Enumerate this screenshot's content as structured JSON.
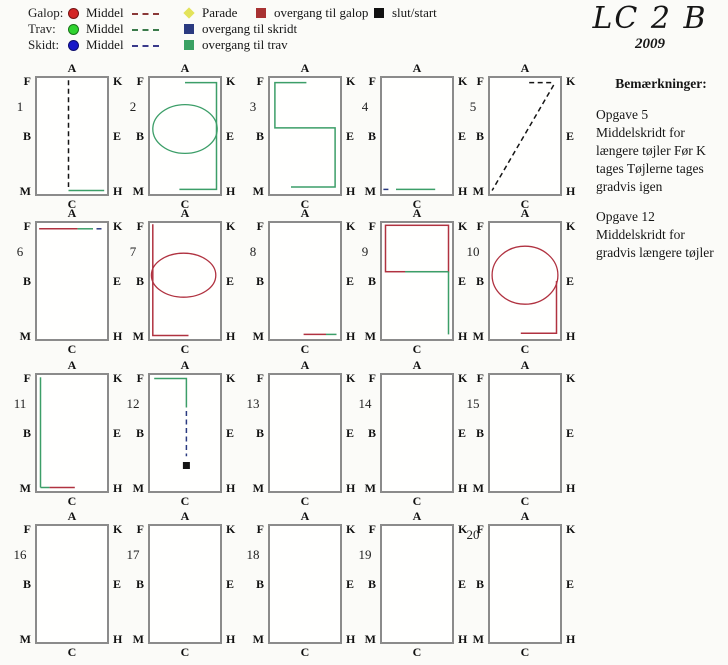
{
  "colors": {
    "green": "#3c9e68",
    "red": "#b03240",
    "navy": "#2a3a80",
    "black": "#151515",
    "rect_border": "#8b8b8b"
  },
  "title": {
    "main": "LC 2 B",
    "year": "2009"
  },
  "legend": {
    "gaits": [
      {
        "label": "Galop:",
        "middel": "Middel",
        "dot_color": "#d42525",
        "dash_color": "#8a3838"
      },
      {
        "label": "Trav:",
        "middel": "Middel",
        "dot_color": "#2fd32f",
        "dash_color": "#3a7a4a"
      },
      {
        "label": "Skidt:",
        "middel": "Middel",
        "dot_color": "#1717c8",
        "dash_color": "#39398a"
      }
    ],
    "markers": [
      {
        "label": "Parade",
        "icon": "parade-diamond-icon",
        "color": "#e3e35a",
        "shape": "diamond",
        "col": 2,
        "row": 1
      },
      {
        "label": "overgang til skridt",
        "icon": "overgang-til-skridt-icon",
        "color": "#2a3a80",
        "shape": "square",
        "col": 2,
        "row": 2
      },
      {
        "label": "overgang til trav",
        "icon": "overgang-til-trav-icon",
        "color": "#3aa163",
        "shape": "square",
        "col": 2,
        "row": 3
      },
      {
        "label": "overgang til galop",
        "icon": "overgang-til-galop-icon",
        "color": "#a83232",
        "shape": "square",
        "col": 3,
        "row": 1
      },
      {
        "label": "slut/start",
        "icon": "slut-start-icon",
        "color": "#111111",
        "shape": "square",
        "col": 4,
        "row": 1
      }
    ]
  },
  "notes": {
    "heading": "Bemærkninger:",
    "items": [
      {
        "title": "Opgave 5",
        "body": "Middelskridt for længere tøjler Før K tages Tøjlerne tages gradvis igen"
      },
      {
        "title": "Opgave 12",
        "body": "Middelskridt for gradvis længere tøjler"
      }
    ]
  },
  "arena_letters": {
    "top_left": "F",
    "top_center": "A",
    "top_right": "K",
    "mid_left": "B",
    "mid_right": "E",
    "bottom_left": "M",
    "bottom_center": "C",
    "bottom_right": "H"
  },
  "arenas": [
    {
      "number": "1",
      "paths": [
        {
          "t": "line",
          "x1": 45,
          "y1": 2,
          "x2": 45,
          "y2": 94,
          "c": "black",
          "d": 1
        },
        {
          "t": "line",
          "x1": 45,
          "y1": 97,
          "x2": 96,
          "y2": 97,
          "c": "green"
        }
      ]
    },
    {
      "number": "2",
      "paths": [
        {
          "t": "polyline",
          "pts": [
            [
              50,
              4
            ],
            [
              95,
              4
            ],
            [
              95,
              96
            ],
            [
              42,
              96
            ]
          ],
          "c": "green"
        },
        {
          "t": "ellipse",
          "cx": 50,
          "cy": 44,
          "rx": 46,
          "ry": 21,
          "c": "green"
        }
      ]
    },
    {
      "number": "3",
      "paths": [
        {
          "t": "polyline",
          "pts": [
            [
              52,
              4
            ],
            [
              7,
              4
            ],
            [
              7,
              43
            ],
            [
              93,
              43
            ],
            [
              93,
              94
            ],
            [
              30,
              94
            ]
          ],
          "c": "green"
        }
      ]
    },
    {
      "number": "4",
      "paths": [
        {
          "t": "line",
          "x1": 2,
          "y1": 96,
          "x2": 13,
          "y2": 96,
          "c": "navy",
          "d": 1
        },
        {
          "t": "line",
          "x1": 20,
          "y1": 96,
          "x2": 76,
          "y2": 96,
          "c": "green"
        }
      ]
    },
    {
      "number": "5",
      "paths": [
        {
          "t": "line",
          "x1": 56,
          "y1": 4,
          "x2": 91,
          "y2": 4,
          "c": "black",
          "d": 1
        },
        {
          "t": "line",
          "x1": 91,
          "y1": 6,
          "x2": 3,
          "y2": 97,
          "c": "black",
          "d": 1
        }
      ]
    },
    {
      "number": "6",
      "paths": [
        {
          "t": "line",
          "x1": 3,
          "y1": 5,
          "x2": 58,
          "y2": 5,
          "c": "red"
        },
        {
          "t": "line",
          "x1": 58,
          "y1": 5,
          "x2": 80,
          "y2": 5,
          "c": "green"
        },
        {
          "t": "line",
          "x1": 85,
          "y1": 5,
          "x2": 95,
          "y2": 5,
          "c": "navy",
          "d": 1
        }
      ]
    },
    {
      "number": "7",
      "paths": [
        {
          "t": "polyline",
          "pts": [
            [
              4,
              1
            ],
            [
              4,
              97
            ],
            [
              55,
              97
            ]
          ],
          "c": "red"
        },
        {
          "t": "ellipse",
          "cx": 48,
          "cy": 45,
          "rx": 46,
          "ry": 19,
          "c": "red"
        }
      ]
    },
    {
      "number": "8",
      "paths": [
        {
          "t": "line",
          "x1": 48,
          "y1": 96,
          "x2": 80,
          "y2": 96,
          "c": "red"
        },
        {
          "t": "line",
          "x1": 80,
          "y1": 96,
          "x2": 95,
          "y2": 96,
          "c": "green"
        }
      ]
    },
    {
      "number": "9",
      "paths": [
        {
          "t": "rect",
          "x": 5,
          "y": 2,
          "w": 90,
          "h": 40,
          "c": "red"
        },
        {
          "t": "line",
          "x1": 33,
          "y1": 42,
          "x2": 95,
          "y2": 42,
          "c": "green"
        },
        {
          "t": "line",
          "x1": 95,
          "y1": 42,
          "x2": 95,
          "y2": 96,
          "c": "green"
        }
      ]
    },
    {
      "number": "10",
      "paths": [
        {
          "t": "ellipse",
          "cx": 50,
          "cy": 45,
          "rx": 47,
          "ry": 25,
          "c": "red"
        },
        {
          "t": "polyline",
          "pts": [
            [
              95,
              50
            ],
            [
              95,
              95
            ],
            [
              44,
              95
            ]
          ],
          "c": "red"
        }
      ]
    },
    {
      "number": "11",
      "paths": [
        {
          "t": "line",
          "x1": 5,
          "y1": 2,
          "x2": 5,
          "y2": 97,
          "c": "green"
        },
        {
          "t": "line",
          "x1": 5,
          "y1": 97,
          "x2": 18,
          "y2": 97,
          "c": "green"
        },
        {
          "t": "line",
          "x1": 18,
          "y1": 97,
          "x2": 54,
          "y2": 97,
          "c": "red"
        }
      ]
    },
    {
      "number": "12",
      "paths": [
        {
          "t": "polyline",
          "pts": [
            [
              6,
              3
            ],
            [
              52,
              3
            ],
            [
              52,
              28
            ]
          ],
          "c": "green"
        },
        {
          "t": "line",
          "x1": 52,
          "y1": 31,
          "x2": 52,
          "y2": 70,
          "c": "navy",
          "d": 1
        },
        {
          "t": "square",
          "x": 52,
          "y": 78,
          "s": 7,
          "c": "black"
        }
      ]
    },
    {
      "number": "13",
      "paths": []
    },
    {
      "number": "14",
      "paths": []
    },
    {
      "number": "15",
      "paths": []
    },
    {
      "number": "16",
      "paths": []
    },
    {
      "number": "17",
      "paths": []
    },
    {
      "number": "18",
      "paths": []
    },
    {
      "number": "19",
      "paths": []
    },
    {
      "number": "20",
      "num_high": true,
      "paths": []
    }
  ]
}
